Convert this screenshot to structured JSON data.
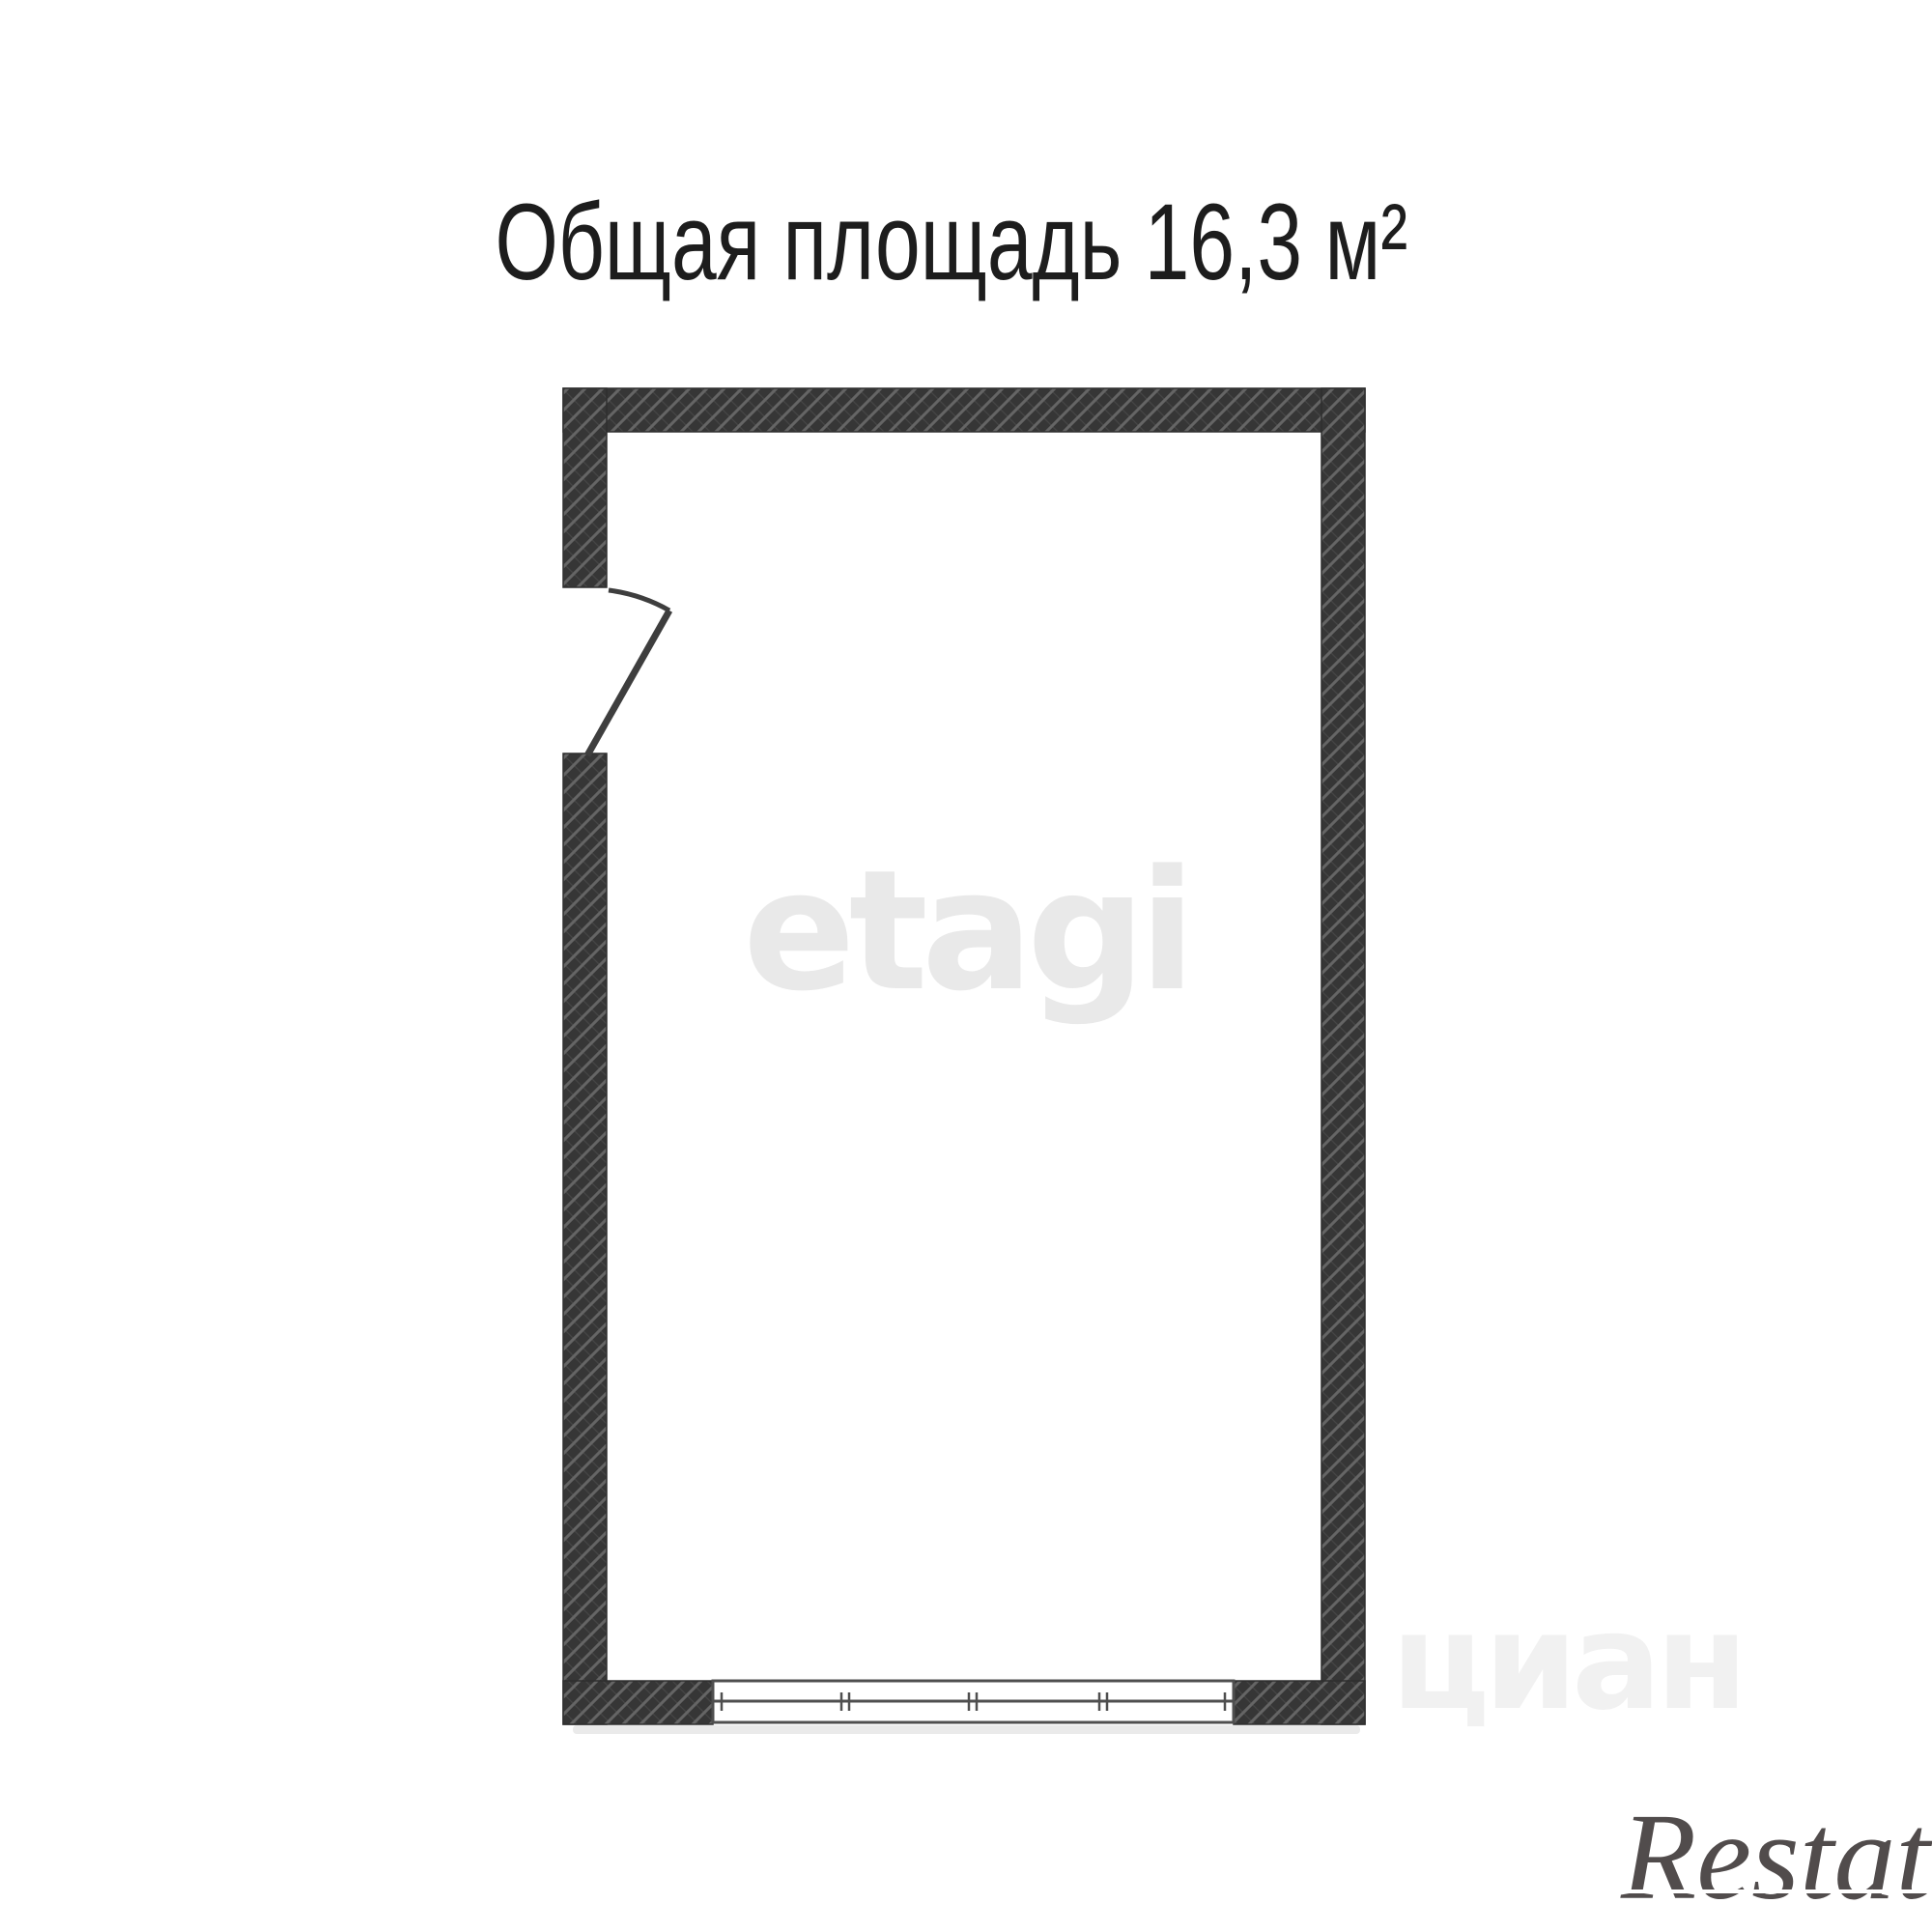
{
  "title": {
    "text": "Общая площадь 16,3 м²",
    "label": "Общая площадь",
    "area_value": "16,3",
    "area_unit": "м²",
    "color": "#1d1d1d"
  },
  "floor_plan": {
    "total_area": "16,3 м²",
    "wall_fill_color": "#363636",
    "wall_hatch_color": "#656565",
    "drawing_line_color": "#3e3e3e",
    "window_line_color": "#4f4f4f",
    "room_fill_color": "#ffffff"
  },
  "watermarks": {
    "center_logo": "etagi",
    "portal_logo": "циан",
    "corner_logo": "Restate"
  }
}
